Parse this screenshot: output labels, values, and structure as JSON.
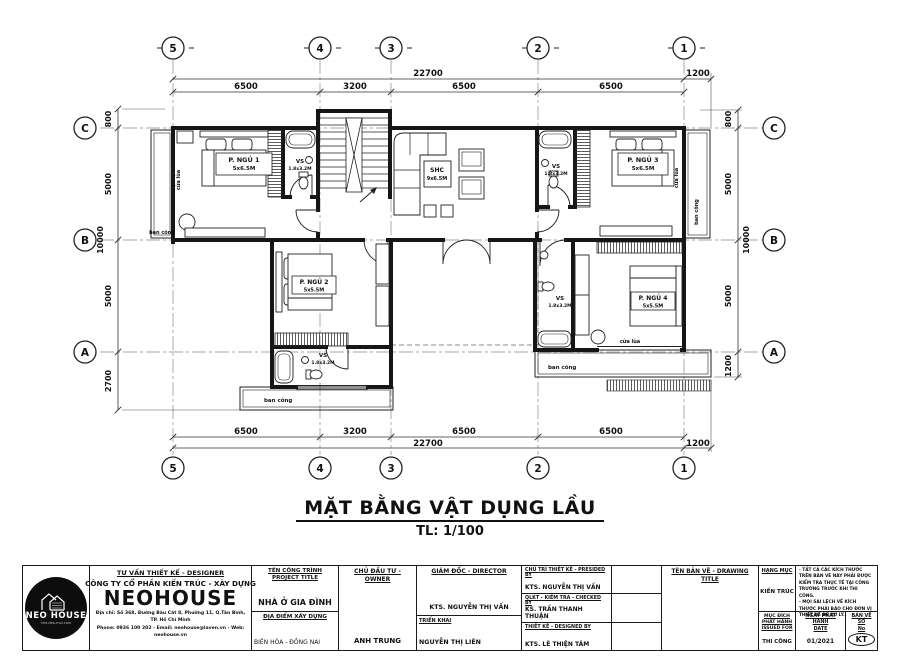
{
  "title": {
    "main": "MẶT BẰNG VẬT DỤNG LẦU",
    "scale": "TL: 1/100"
  },
  "grid": {
    "cols": [
      "5",
      "4",
      "3",
      "2",
      "1"
    ],
    "rows": [
      "C",
      "B",
      "A"
    ]
  },
  "dimensions": {
    "top": {
      "overall": "22700",
      "segments": [
        "6500",
        "3200",
        "6500",
        "6500"
      ],
      "right_ext": "1200"
    },
    "bottom": {
      "overall": "22700",
      "segments": [
        "6500",
        "3200",
        "6500",
        "6500"
      ],
      "right_ext": "1200"
    },
    "left": {
      "segments": [
        "800",
        "5000",
        "5000",
        "2700"
      ],
      "overall": "10000"
    },
    "right": {
      "segments": [
        "800",
        "5000",
        "5000",
        "1200"
      ],
      "overall": "10000"
    }
  },
  "rooms": {
    "bed1": {
      "name": "P. NGỦ 1",
      "size": "5x6.5M"
    },
    "bed2": {
      "name": "P. NGỦ 2",
      "size": "5x5.5M"
    },
    "bed3": {
      "name": "P. NGỦ 3",
      "size": "5x6.5M"
    },
    "bed4": {
      "name": "P. NGỦ 4",
      "size": "5x5.5M"
    },
    "living": {
      "name": "SHC",
      "size": "9x6.5M"
    },
    "vs": {
      "name": "VS",
      "size": "1.8x3.2M"
    }
  },
  "labels": {
    "balcony": "ban công",
    "sliding": "cửa lùa"
  },
  "title_block": {
    "logo": {
      "brand": "NEO HOUSE",
      "tagline": "nha.dep.moi.com"
    },
    "designer_heading": "TƯ VẤN THIẾT KẾ - DESIGNER",
    "company": "CÔNG TY CỔ PHẦN KIẾN TRÚC - XÂY DỰNG",
    "brand": "NEOHOUSE",
    "address": "Địa chỉ: Số 368, Đường Bàu Cát 8, Phường 11, Q.Tân Bình, TP. Hồ Chí Minh",
    "contact": "Phone: 0936 100 202 - Email: neohouse@laven.vn - Web: neohouse.vn",
    "project": {
      "heading": "TÊN CÔNG TRÌNH",
      "heading_en": "PROJECT TITLE",
      "value": "NHÀ Ở GIA ĐÌNH",
      "location_heading": "ĐỊA ĐIỂM XÂY DỰNG",
      "location": "BIÊN HÒA - ĐỒNG NAI"
    },
    "owner": {
      "heading": "CHỦ ĐẦU TƯ - OWNER",
      "value": "ANH TRUNG"
    },
    "director": {
      "heading": "GIÁM ĐỐC - DIRECTOR",
      "value": "KTS. NGUYỄN THỊ VẤN",
      "deploy_heading": "TRIỂN KHAI",
      "deploy": "NGUYỄN THỊ LIÊN"
    },
    "presided": {
      "heading": "CHỦ TRÌ THIẾT KẾ - PRESIDED BY",
      "value": "KTS. NGUYỄN THỊ VẤN"
    },
    "checked": {
      "heading": "QLKT - KIỂM TRA - CHECKED BY",
      "value": "KS. TRẦN THANH THUẬN"
    },
    "designed": {
      "heading": "THIẾT KẾ - DESIGNED BY",
      "value": "KTS. LÊ THIỆN TÂM"
    },
    "drawing_title_heading": "TÊN BẢN VẼ - DRAWING TITLE",
    "category": {
      "heading": "HẠNG MỤC",
      "value": "KIẾN TRÚC"
    },
    "notes": [
      "- TẤT CẢ CÁC KÍCH THƯỚC TRÊN BẢN VẼ NÀY PHẢI ĐƯỢC KIỂM TRA THỰC TẾ TẠI CÔNG TRƯỜNG TRƯỚC KHI THI CÔNG.",
      "- MỌI SAI LỆCH VỀ KÍCH THƯỚC PHẢI BÁO CHO ĐƠN VỊ THIẾT KẾ ĐỂ XỬ LÝ."
    ],
    "issued_for": {
      "heading": "MỤC ĐÍCH PHÁT HÀNH",
      "heading_en": "ISSUED FOR",
      "value": "THI CÔNG"
    },
    "date": {
      "heading": "NGÀY PHÁT HÀNH",
      "heading_en": "DATE",
      "value": "01/2021"
    },
    "sheet": {
      "heading": "BẢN VẼ SỐ",
      "heading_en": "No",
      "value": "KT"
    }
  }
}
